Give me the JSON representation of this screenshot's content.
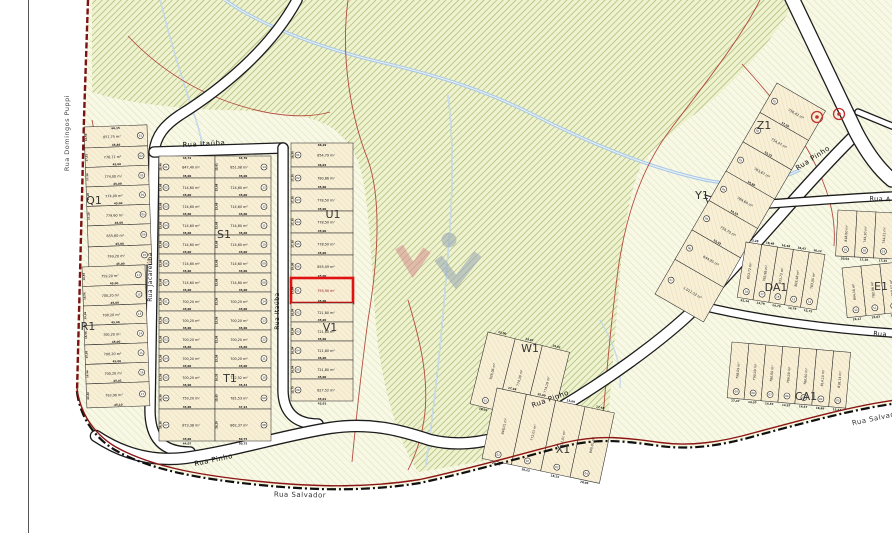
{
  "streets": {
    "domingos_puppi": "Rua Domingos Puppi",
    "itauba_top": "Rua Itaúba",
    "itauba_side": "Rua Itaúba",
    "jacareuba": "Rua Jacareúba",
    "pinho_w": "Rua Pinho",
    "pinho_c": "Rua Pinho",
    "pinho_ne": "Rua Pinho",
    "salvador_w": "Rua Salvador",
    "salvador_e": "Rua Salvador",
    "rua_a": "Rua A",
    "rua_east": "Rua"
  },
  "highlight": {
    "color": "#e01212",
    "lot": "01",
    "area": "793,90 m²",
    "block": "V1"
  },
  "markers": {
    "color": "#c03030",
    "count": 2
  },
  "watermark": {
    "red": "#d68f8f",
    "gray": "#97a7b5"
  },
  "colors": {
    "boundary_red": "#8c1616",
    "boundary_black": "#101010",
    "contour": "#ad3a2e",
    "stream": "#a9c8e4",
    "lot_fill": "#f8efd7",
    "forest_line": "#9fae62",
    "pale_line": "#dedfb2"
  },
  "blocks": [
    {
      "id": "Q1",
      "label": "Q1",
      "lots": [
        {
          "n": "01",
          "area": "857,75 m²",
          "front": "45,86",
          "top": "66,15",
          "side": "16,50"
        },
        {
          "n": "02",
          "area": "776,71 m²",
          "front": "45,00",
          "side": "17,31"
        },
        {
          "n": "03",
          "area": "774,00 m²",
          "front": "45,00",
          "side": "17,20"
        },
        {
          "n": "04",
          "area": "774,00 m²",
          "front": "45,00",
          "side": "17,20"
        },
        {
          "n": "05",
          "area": "779,60 m²",
          "front": "45,00",
          "side": "17,20"
        },
        {
          "n": "06",
          "area": "855,60 m²",
          "front": "45,00"
        },
        {
          "n": "07",
          "area": "799,20 m²",
          "front": "45,00"
        }
      ]
    },
    {
      "id": "R1",
      "label": "R1",
      "lots": [
        {
          "n": "11",
          "area": "759,20 m²",
          "front": "45,00",
          "side": "16,56"
        },
        {
          "n": "12",
          "area": "700,20 m²",
          "front": "45,00",
          "side": "15,56"
        },
        {
          "n": "13",
          "area": "700,20 m²",
          "front": "45,00",
          "side": "15,56"
        },
        {
          "n": "14",
          "area": "700,20 m²",
          "front": "45,00",
          "side": "15,56"
        },
        {
          "n": "15",
          "area": "700,20 m²",
          "front": "45,00",
          "side": "15,56"
        },
        {
          "n": "16",
          "area": "700,20 m²",
          "front": "45,01",
          "side": "15,56"
        },
        {
          "n": "17",
          "area": "793,90 m²",
          "front": "45,10",
          "side": "23,36"
        }
      ]
    },
    {
      "id": "S1",
      "label": "S1",
      "cols": [
        {
          "lots": [
            {
              "n": "01",
              "area": "847,40 m²",
              "front": "45,00",
              "top": "43,72",
              "side": "15,46"
            },
            {
              "n": "02",
              "area": "714,60 m²",
              "front": "45,00",
              "side": "15,68"
            },
            {
              "n": "03",
              "area": "714,60 m²",
              "front": "45,00",
              "side": "15,68"
            },
            {
              "n": "04",
              "area": "714,60 m²",
              "front": "45,00",
              "side": "15,68"
            },
            {
              "n": "05",
              "area": "714,60 m²",
              "front": "45,00",
              "side": "15,68"
            },
            {
              "n": "06",
              "area": "714,60 m²",
              "front": "45,00",
              "side": "15,68"
            },
            {
              "n": "07",
              "area": "714,60 m²",
              "front": "45,00",
              "side": "15,68"
            }
          ]
        },
        {
          "lots": [
            {
              "n": "14",
              "area": "851,08 m²",
              "front": "45,00",
              "top": "43,70",
              "side": "15,61"
            },
            {
              "n": "13",
              "area": "714,60 m²",
              "front": "45,00",
              "side": "15,68"
            },
            {
              "n": "12",
              "area": "714,60 m²",
              "front": "45,00",
              "side": "15,68"
            },
            {
              "n": "11",
              "area": "714,60 m²",
              "front": "45,00",
              "side": "15,68"
            },
            {
              "n": "10",
              "area": "714,60 m²",
              "front": "45,00",
              "side": "15,68"
            },
            {
              "n": "09",
              "area": "714,60 m²",
              "front": "45,00",
              "side": "15,68"
            },
            {
              "n": "08",
              "area": "714,60 m²",
              "front": "45,00",
              "side": "15,68"
            }
          ]
        }
      ]
    },
    {
      "id": "T1",
      "label": "T1",
      "cols": [
        {
          "lots": [
            {
              "n": "01",
              "area": "700,20 m²",
              "front": "45,00",
              "side": "15,56"
            },
            {
              "n": "02",
              "area": "700,20 m²",
              "front": "45,00",
              "side": "15,56"
            },
            {
              "n": "03",
              "area": "700,20 m²",
              "front": "45,00",
              "side": "15,56"
            },
            {
              "n": "04",
              "area": "700,20 m²",
              "front": "45,00",
              "side": "15,56"
            },
            {
              "n": "05",
              "area": "700,20 m²",
              "front": "45,00",
              "side": "15,56"
            },
            {
              "n": "06",
              "area": "759,20 m²",
              "front": "45,00",
              "side": "16,56"
            },
            {
              "n": "07",
              "area": "873,38 m²",
              "front": "45,00",
              "bottom": "44,07",
              "side": "19,30"
            }
          ]
        },
        {
          "lots": [
            {
              "n": "14",
              "area": "700,20 m²",
              "front": "45,00",
              "side": "15,56"
            },
            {
              "n": "13",
              "area": "700,20 m²",
              "front": "45,00",
              "side": "15,56"
            },
            {
              "n": "12",
              "area": "700,20 m²",
              "front": "45,00",
              "side": "15,56"
            },
            {
              "n": "11",
              "area": "700,20 m²",
              "front": "45,00",
              "side": "15,56"
            },
            {
              "n": "10",
              "area": "722,52 m²",
              "front": "45,44",
              "side": "16,35"
            },
            {
              "n": "09",
              "area": "781,53 m²",
              "front": "47,24",
              "side": "15,65"
            },
            {
              "n": "08",
              "area": "862,37 m²",
              "front": "50,75",
              "bottom": "50,75",
              "side": "26,29"
            }
          ]
        }
      ]
    },
    {
      "id": "U1",
      "label": "U1",
      "lots": [
        {
          "n": "01",
          "area": "854,79 m²",
          "front": "46,04",
          "top": "66,29",
          "side": "16,50"
        },
        {
          "n": "02",
          "area": "780,86 m²",
          "front": "45,00",
          "side": "17,30"
        },
        {
          "n": "03",
          "area": "778,50 m²",
          "front": "45,00",
          "side": "17,30"
        },
        {
          "n": "04",
          "area": "778,50 m²",
          "front": "45,00",
          "side": "17,30"
        },
        {
          "n": "05",
          "area": "778,50 m²",
          "front": "45,00",
          "side": "17,30"
        },
        {
          "n": "06",
          "area": "855,09 m²",
          "front": "45,00",
          "side": "19,00"
        }
      ]
    },
    {
      "id": "V1",
      "label": "V1",
      "lots": [
        {
          "n": "01",
          "area": "793,90 m²",
          "front": "45,00",
          "side": "17,84",
          "highlighted": true
        },
        {
          "n": "02",
          "area": "721,80 m²",
          "front": "45,00",
          "side": "16,04"
        },
        {
          "n": "03",
          "area": "721,80 m²",
          "front": "45,00",
          "side": "16,04"
        },
        {
          "n": "04",
          "area": "721,80 m²",
          "front": "45,00",
          "side": "16,04"
        },
        {
          "n": "05",
          "area": "721,80 m²",
          "front": "45,00",
          "side": "16,04"
        },
        {
          "n": "06",
          "area": "827,52 m²",
          "front": "43,01",
          "bottom": "43,01",
          "side": "15,75"
        }
      ]
    },
    {
      "id": "W1",
      "label": "W1",
      "lots": [
        {
          "n": "01",
          "area": "928,06 m²",
          "front": "28,02",
          "top": "13,00"
        },
        {
          "n": "02",
          "area": "774,38 m²",
          "front": "20,36",
          "top": "13,97"
        },
        {
          "n": "03",
          "area": "774,19 m²",
          "front": "18,21",
          "top": "15,01"
        }
      ]
    },
    {
      "id": "X1",
      "label": "X1",
      "lots": [
        {
          "n": "01",
          "area": "848,01 m²",
          "front": "20,05",
          "top": "17,48"
        },
        {
          "n": "02",
          "area": "772,01 m²",
          "front": "18,23",
          "top": "15,69"
        },
        {
          "n": "03",
          "area": "772,01 m²",
          "front": "18,23",
          "top": "15,69"
        },
        {
          "n": "04",
          "area": "840,01 m²",
          "front": "20,05",
          "top": "17,48"
        }
      ]
    },
    {
      "id": "Z1",
      "label": "Z1",
      "lots": [
        {
          "n": "01",
          "area": "756,42 m²",
          "front": "17,50"
        },
        {
          "n": "02",
          "area": "754,47 m²",
          "front": "15,32"
        },
        {
          "n": "03",
          "area": "763,67 m²",
          "front": "14,66"
        }
      ]
    },
    {
      "id": "Y1",
      "label": "Y1",
      "lots": [
        {
          "n": "04",
          "area": "769,60 m²",
          "front": "14,55"
        },
        {
          "n": "05",
          "area": "759,70 m²",
          "front": "15,02"
        },
        {
          "n": "06",
          "area": "644,95 m²"
        },
        {
          "n": "07",
          "area": "1.011,52 m²"
        }
      ]
    },
    {
      "id": "DA1",
      "label": "DA1",
      "lots": [
        {
          "n": "18",
          "area": "853,72 m²",
          "front": "25,14",
          "top": "13,28"
        },
        {
          "n": "17",
          "area": "792,98 m²",
          "front": "14,79",
          "top": "16,48"
        },
        {
          "n": "16",
          "area": "833,72 m²",
          "front": "14,79",
          "top": "16,48"
        },
        {
          "n": "15",
          "area": "803,48 m²",
          "front": "14,79",
          "top": "16,43"
        },
        {
          "n": "14",
          "area": "783,05 m²",
          "front": "15,75",
          "top": "16,12"
        }
      ]
    },
    {
      "id": "CA1",
      "label": "CA1",
      "lots": [
        {
          "n": "09",
          "area": "798,09 m²",
          "front": "17,47"
        },
        {
          "n": "08",
          "area": "790,09 m²",
          "front": "14,57"
        },
        {
          "n": "07",
          "area": "780,60 m²",
          "front": "14,57"
        },
        {
          "n": "06",
          "area": "789,09 m²",
          "front": "14,57"
        },
        {
          "n": "05",
          "area": "780,60 m²",
          "front": "14,57"
        },
        {
          "n": "04",
          "area": "814,10 m²",
          "front": "16,69"
        },
        {
          "n": "03",
          "area": "818,14 m²",
          "front": "15,43"
        }
      ]
    },
    {
      "id": "RA",
      "label": "",
      "lots": [
        {
          "n": "01",
          "area": "818,60 m²",
          "front": "20,04"
        },
        {
          "n": "02",
          "area": "744,30 m²",
          "front": "17,26"
        },
        {
          "n": "03",
          "area": "744,22 m²",
          "front": "17,25"
        }
      ]
    },
    {
      "id": "E1",
      "label": "E1",
      "lots": [
        {
          "n": "12",
          "area": "844,16 m²",
          "front": "16,12"
        },
        {
          "n": "11",
          "area": "782,96 m²",
          "front": "15,63"
        },
        {
          "n": "10",
          "area": "858,57 m²",
          "front": "15,43"
        }
      ]
    }
  ]
}
